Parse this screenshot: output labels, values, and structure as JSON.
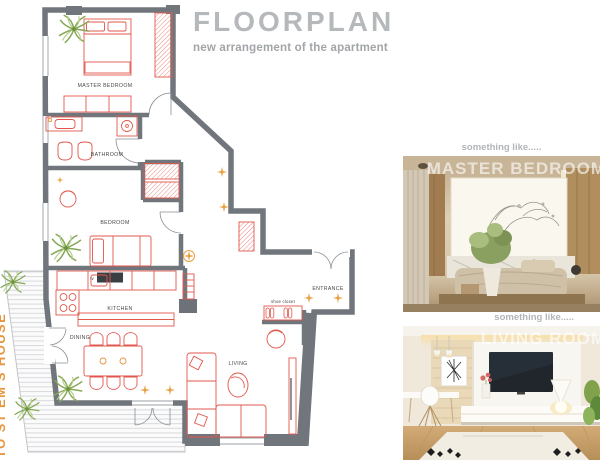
{
  "header": {
    "title": "FLOORPLAN",
    "subtitle": "new arrangement of the apartment"
  },
  "side_text": "TO ST EM'S HOUSE",
  "floorplan": {
    "labels": {
      "master_bedroom": "MASTER BEDROOM",
      "bathroom": "BATHROOM",
      "bedroom": "BEDROOM",
      "kitchen": "KITCHEN",
      "dining": "DINING",
      "living": "LIVING",
      "entrance": "ENTRANCE",
      "shoe_closet": "shoe closet",
      "tv": "tv"
    }
  },
  "photos": [
    {
      "caption": "something like.....",
      "title": "MASTER BEDROOM"
    },
    {
      "caption": "something like.....",
      "title": "LIVING ROOM"
    }
  ],
  "colors": {
    "wall_gray": "#71767c",
    "furniture_red": "#e2574c",
    "accent_orange": "#e8953d",
    "plant_green": "#85a855",
    "title_gray": "#b6b9bc"
  }
}
